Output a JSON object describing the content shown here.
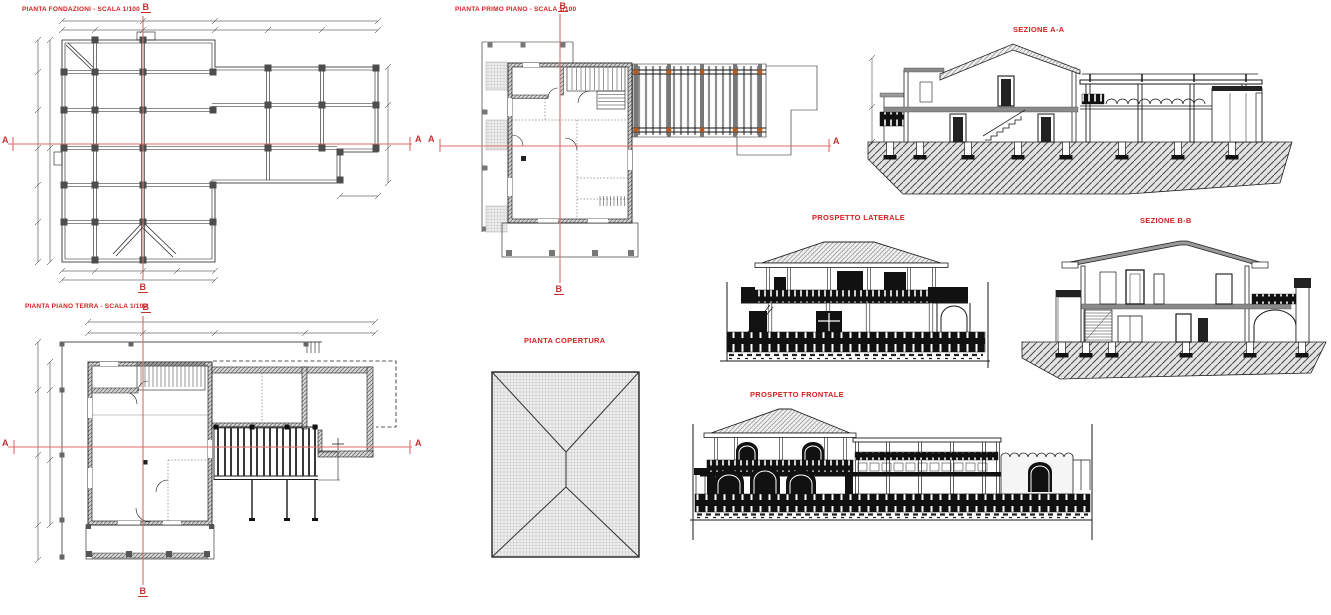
{
  "sheet": {
    "background": "#ffffff",
    "annotation_red": "#d31f1f",
    "section_line_red": "#e06a6a",
    "drawing_black": "#1a1a1a",
    "wood_post_orange": "#b25a1e"
  },
  "views": {
    "foundation_plan": {
      "title": "PIANTA FONDAZIONI - SCALA 1/100"
    },
    "first_floor_plan": {
      "title": "PIANTA PRIMO PIANO - SCALA 1/100"
    },
    "section_aa": {
      "title": "SEZIONE A-A"
    },
    "side_elevation": {
      "title": "PROSPETTO LATERALE"
    },
    "section_bb": {
      "title": "SEZIONE B-B"
    },
    "ground_floor_plan": {
      "title": "PIANTA PIANO TERRA - SCALA 1/100"
    },
    "roof_plan": {
      "title": "PIANTA COPERTURA"
    },
    "front_elevation": {
      "title": "PROSPETTO FRONTALE"
    }
  },
  "section_markers": {
    "a": "A",
    "b": "B"
  }
}
